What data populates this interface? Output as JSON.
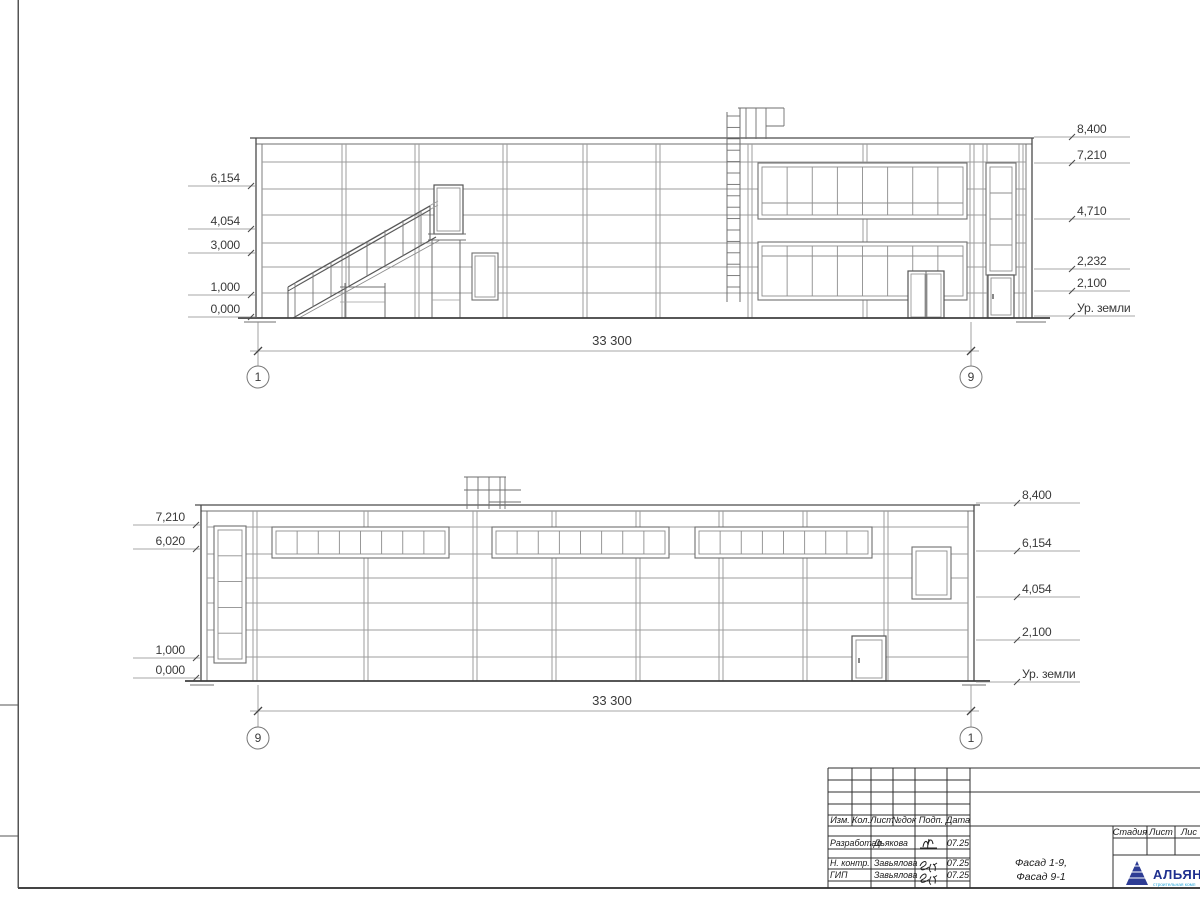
{
  "facade_top": {
    "dimension": "33 300",
    "axis_left": "1",
    "axis_right": "9",
    "marks_left": [
      "6,154",
      "4,054",
      "3,000",
      "1,000",
      "0,000"
    ],
    "marks_right": [
      "8,400",
      "7,210",
      "4,710",
      "2,232",
      "2,100",
      "Ур. земли"
    ]
  },
  "facade_bottom": {
    "dimension": "33 300",
    "axis_left": "9",
    "axis_right": "1",
    "marks_left": [
      "7,210",
      "6,020",
      "1,000",
      "0,000"
    ],
    "marks_right": [
      "8,400",
      "6,154",
      "4,054",
      "2,100",
      "Ур. земли"
    ]
  },
  "title_block": {
    "header_cols": [
      "Изм.",
      "Кол.",
      "Лист",
      "№док",
      "Подп.",
      "Дата"
    ],
    "rows": [
      {
        "role": "Разработал",
        "name": "Дьякова",
        "date": "07.25"
      },
      {
        "role": "Н. контр.",
        "name": "Завьялова",
        "date": "07.25"
      },
      {
        "role": "ГИП",
        "name": "Завьялова",
        "date": "07.25"
      }
    ],
    "stage_cols": [
      "Стадия",
      "Лист",
      "Лис"
    ],
    "doc_title_1": "Фасад 1-9,",
    "doc_title_2": "Фасад 9-1",
    "logo": {
      "name": "АЛЬЯН",
      "sub": "строительная комп"
    }
  },
  "colors": {
    "line": "#4a4a4a",
    "thin": "#9c9c9c",
    "logo_blue": "#2d3c94",
    "logo_light_blue": "#29a8dd"
  }
}
